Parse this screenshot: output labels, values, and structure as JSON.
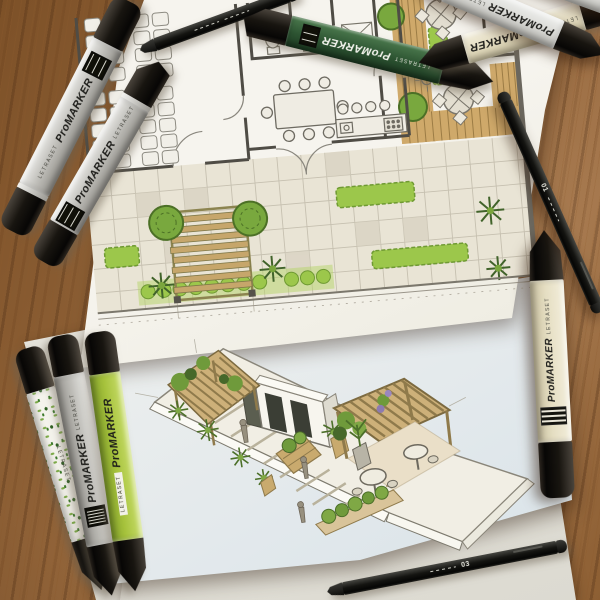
{
  "photo": {
    "caption": "Hand-drawn landscape architecture floor plan and axonometric courtyard sketch on a wooden desk, surrounded by Letraset ProMarker markers and fineliner pens"
  },
  "branding": {
    "promarker": "ProMARKER",
    "letraset": "LETRASET"
  },
  "pens": {
    "size01": "01",
    "size03": "03"
  },
  "colors": {
    "wood": "#93653a",
    "plan_paper": "#f6f4ee",
    "axon_paper": "#eef0ef",
    "cap_black": "#181510",
    "marker_silver": "#c2c1bc",
    "marker_dark_green": "#2c5331",
    "marker_lime": "#a6c23c",
    "marker_cream": "#e5dec2",
    "hedge_green": "#9cc74b",
    "tree_green": "#7aa63d",
    "palm_green": "#41632a",
    "deck_tan": "#c9a96b",
    "pencil": "#706e66"
  }
}
